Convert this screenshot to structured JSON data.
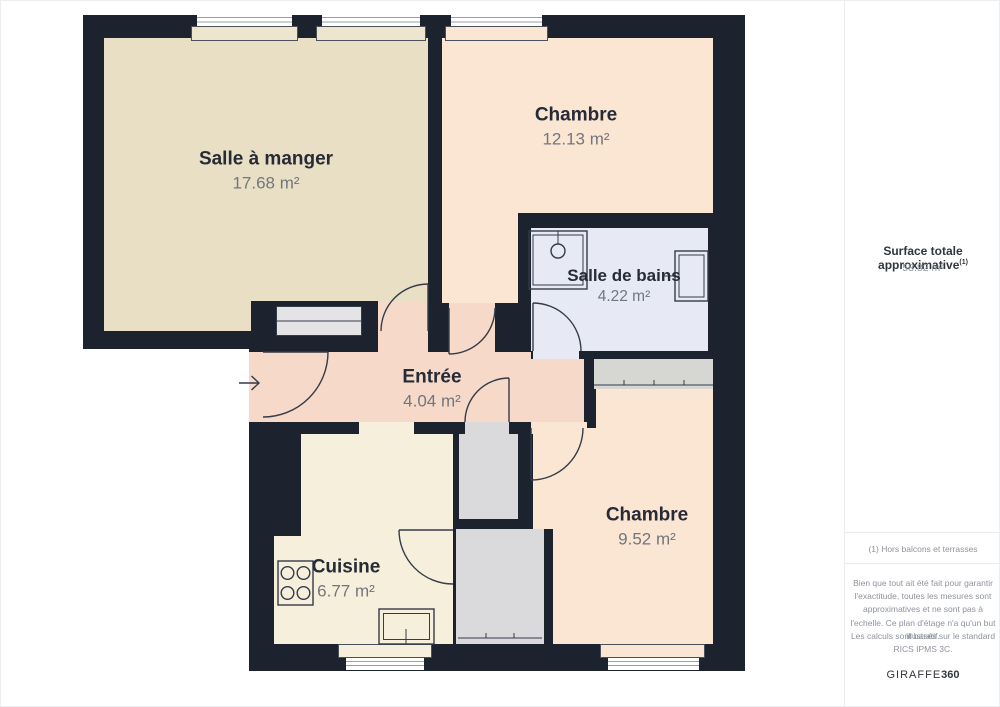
{
  "plan": {
    "rooms": [
      {
        "name": "Salle à manger",
        "area": "17.68 m²"
      },
      {
        "name": "Chambre",
        "area": "12.13 m²"
      },
      {
        "name": "Salle de bains",
        "area": "4.22 m²"
      },
      {
        "name": "Entrée",
        "area": "4.04 m²"
      },
      {
        "name": "Cuisine",
        "area": "6.77 m²"
      },
      {
        "name": "Chambre",
        "area": "9.52 m²"
      }
    ],
    "colors": {
      "wall": "#1c222e",
      "salle_a_manger": "#e8dfc5",
      "chambre": "#fbe6d3",
      "salle_de_bains": "#e7eaf4",
      "entree": "#f6d9c8",
      "cuisine": "#f5efdc",
      "closet": "#dadadc"
    }
  },
  "sidebar": {
    "total_label": "Surface totale approximative",
    "total_marker": "(1)",
    "total_value": "58.82 m²",
    "footnote": "(1) Hors balcons et terrasses",
    "disclaimer": "Bien que tout ait été fait pour garantir l'exactitude, toutes les mesures sont approximatives et ne sont pas à l'echelle. Ce plan d'étage n'a qu'un but illustratif.",
    "standard": "Les calculs sont basés sur le standard RICS IPMS 3C.",
    "brand_name": "GIRAFFE",
    "brand_suffix": "360"
  }
}
